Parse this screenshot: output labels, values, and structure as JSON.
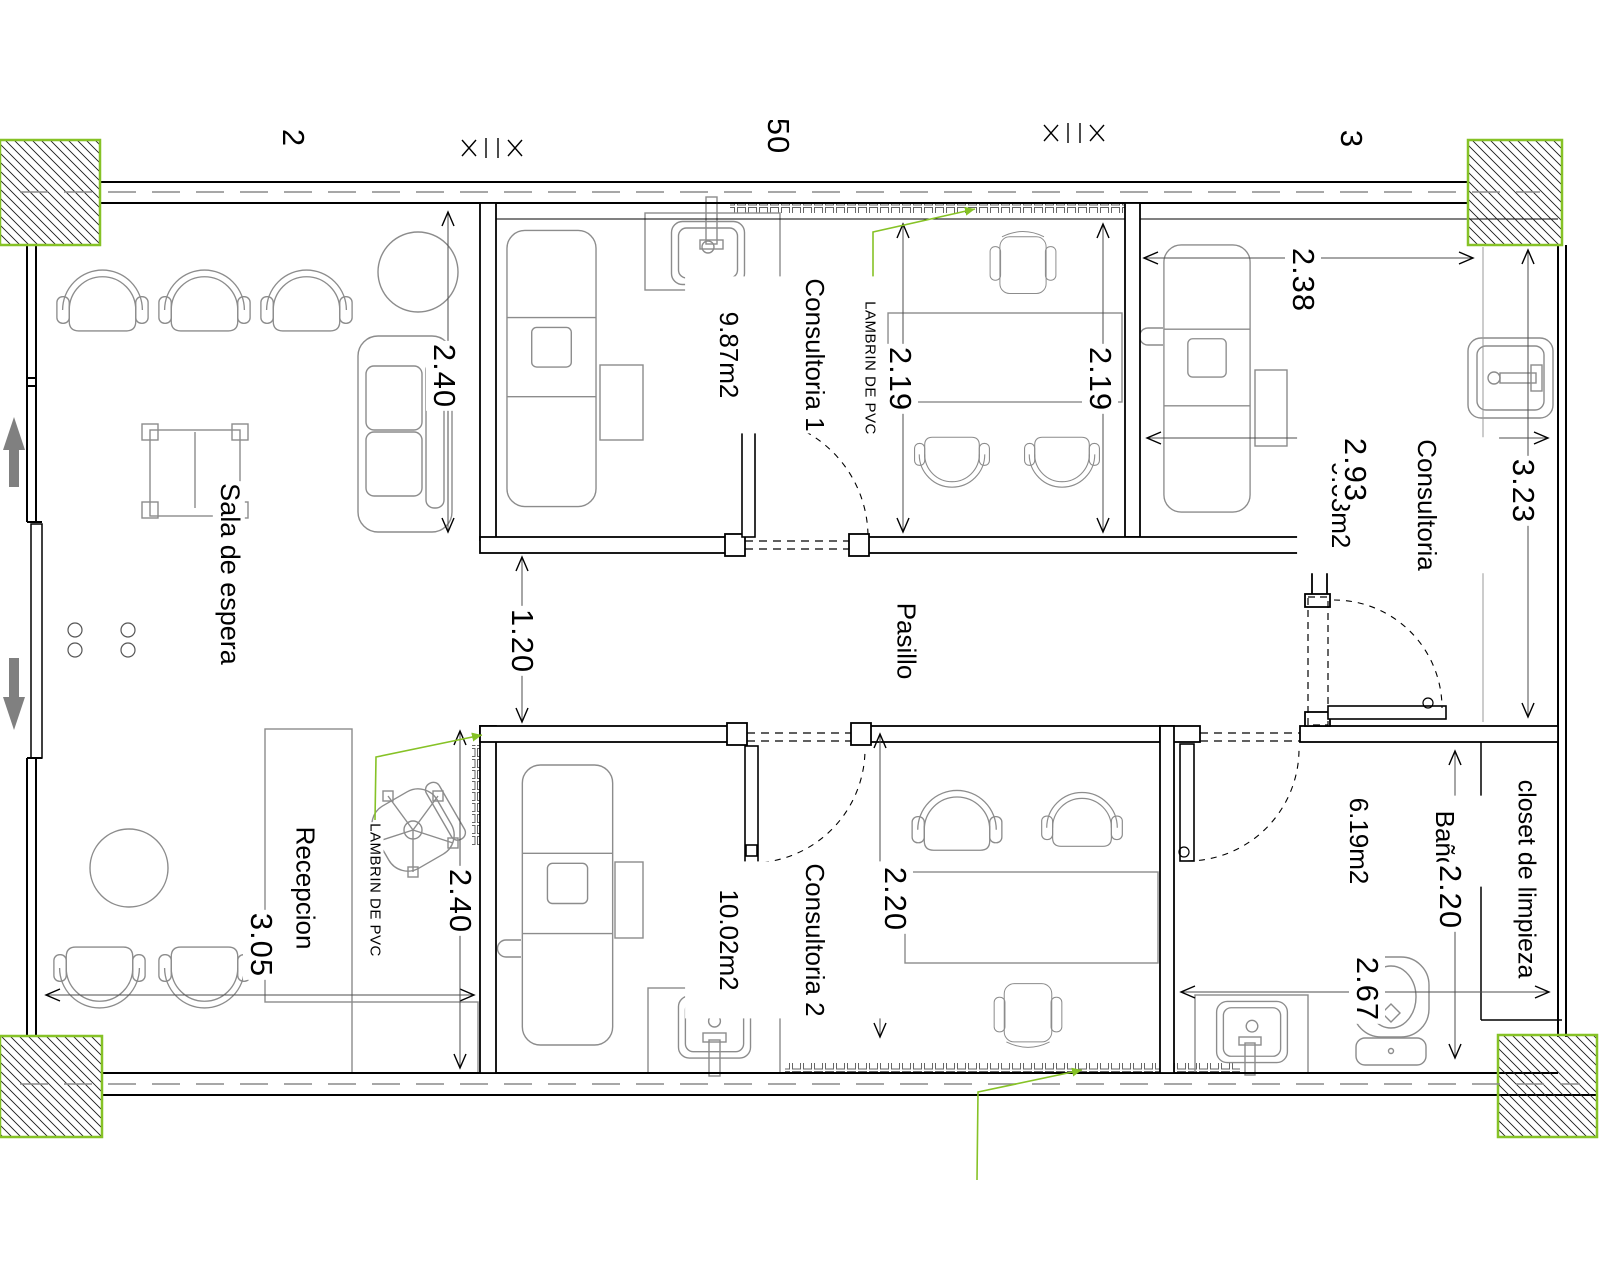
{
  "rooms": {
    "sala_de_espera": {
      "label": "Sala de espera"
    },
    "consultoria_1": {
      "label": "Consultoria 1",
      "area": "9.87m2"
    },
    "consultoria_top": {
      "label": "Consultoria",
      "area": "9.03m2"
    },
    "consultoria_2": {
      "label": "Consultoria 2",
      "area": "10.02m2"
    },
    "pasillo": {
      "label": "Pasillo"
    },
    "recepcion": {
      "label": "Recepcion"
    },
    "bano": {
      "label": "Baño",
      "area": "6.19m2"
    },
    "closet": {
      "label": "closet de limpieza"
    }
  },
  "dims": {
    "d240_top": "2.40",
    "d120_pasillo": "1.20",
    "d219_left": "2.19",
    "d219_right": "2.19",
    "d238": "2.38",
    "d293": "2.93",
    "d323": "3.23",
    "d305_recepcion": "3.05",
    "d240_bottom": "2.40",
    "d220_consultoria2": "2.20",
    "d220_bano": "2.20",
    "d267_bano": "2.67"
  },
  "annotations": {
    "lambrin_top": "LAMBRIN DE PVC",
    "lambrin_recepcion": "LAMBRIN DE PVC"
  },
  "edge_labels": {
    "left": "2",
    "center": "50",
    "right": "3"
  },
  "colors": {
    "accent_green": "#86C226",
    "line_black": "#000000",
    "furniture_gray": "#8C8C8C",
    "arrow_gray": "#808080"
  }
}
